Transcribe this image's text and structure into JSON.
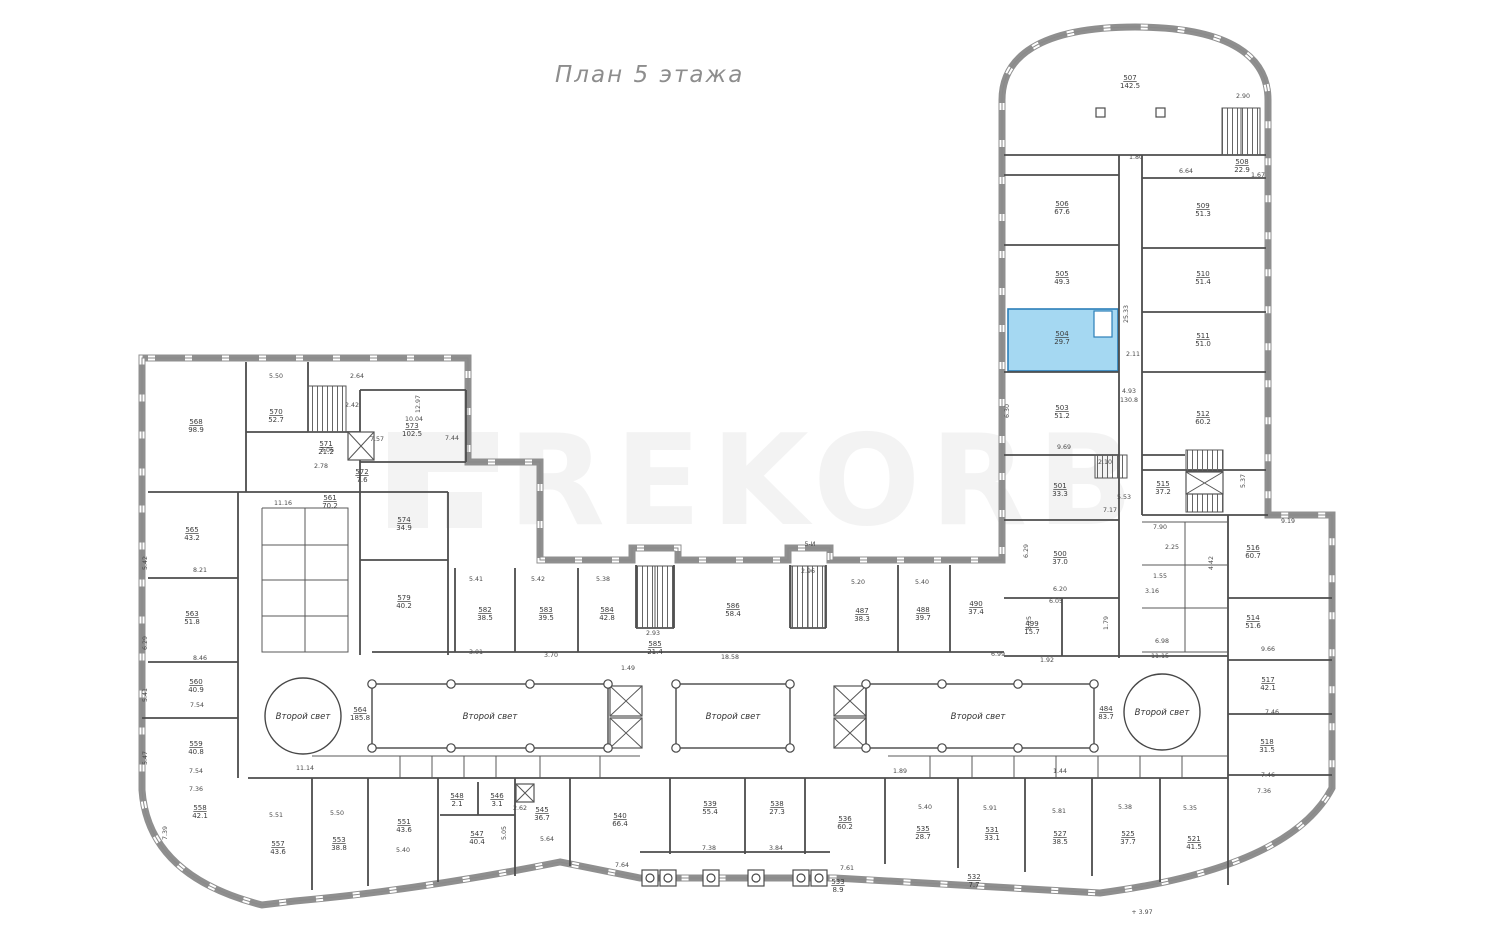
{
  "page": {
    "title": "План 5 этажа",
    "watermark": "REKORB",
    "elevation_note": "+ 3.97",
    "axis_note": "5-И"
  },
  "colors": {
    "highlight_fill": "#A5D8F2",
    "highlight_border": "#2B7FB8"
  },
  "atrium": {
    "label": "Второй свет"
  },
  "highlight": {
    "room": "504",
    "area": "29.7"
  },
  "rooms": {
    "r568": {
      "n": "568",
      "a": "98.9"
    },
    "r570": {
      "n": "570",
      "a": "52.7"
    },
    "r571": {
      "n": "571",
      "a": "21.2"
    },
    "r572": {
      "n": "572",
      "a": "7.6"
    },
    "r573": {
      "n": "573",
      "a": "102.5"
    },
    "r561": {
      "n": "561",
      "a": "70.2"
    },
    "r574": {
      "n": "574",
      "a": "34.9"
    },
    "r565": {
      "n": "565",
      "a": "43.2"
    },
    "r563": {
      "n": "563",
      "a": "51.8"
    },
    "r560": {
      "n": "560",
      "a": "40.9"
    },
    "r559": {
      "n": "559",
      "a": "40.8"
    },
    "r558": {
      "n": "558",
      "a": "42.1"
    },
    "r557": {
      "n": "557",
      "a": "43.6"
    },
    "r553": {
      "n": "553",
      "a": "38.8"
    },
    "r551": {
      "n": "551",
      "a": "43.6"
    },
    "r548": {
      "n": "548",
      "a": "2.1"
    },
    "r546": {
      "n": "546",
      "a": "3.1"
    },
    "r547": {
      "n": "547",
      "a": "40.4"
    },
    "r545": {
      "n": "545",
      "a": "36.7"
    },
    "r540": {
      "n": "540",
      "a": "66.4"
    },
    "r539": {
      "n": "539",
      "a": "55.4"
    },
    "r538": {
      "n": "538",
      "a": "27.3"
    },
    "r536": {
      "n": "536",
      "a": "60.2"
    },
    "r535": {
      "n": "535",
      "a": "28.7"
    },
    "r531": {
      "n": "531",
      "a": "33.1"
    },
    "r527": {
      "n": "527",
      "a": "38.5"
    },
    "r525": {
      "n": "525",
      "a": "37.7"
    },
    "r521": {
      "n": "521",
      "a": "41.5"
    },
    "r533": {
      "n": "533",
      "a": "8.9"
    },
    "r532": {
      "n": "532",
      "a": "7.7"
    },
    "r579": {
      "n": "579",
      "a": "40.2"
    },
    "r582": {
      "n": "582",
      "a": "38.5"
    },
    "r583": {
      "n": "583",
      "a": "39.5"
    },
    "r584": {
      "n": "584",
      "a": "42.8"
    },
    "r585": {
      "n": "585",
      "a": "21.4"
    },
    "r586": {
      "n": "586",
      "a": "58.4"
    },
    "r487": {
      "n": "487",
      "a": "38.3"
    },
    "r488": {
      "n": "488",
      "a": "39.7"
    },
    "r490": {
      "n": "490",
      "a": "37.4"
    },
    "r564": {
      "n": "564",
      "a": "185.8"
    },
    "r484": {
      "n": "484",
      "a": "83.7"
    },
    "r507": {
      "n": "507",
      "a": "142.5"
    },
    "r508": {
      "n": "508",
      "a": "22.9"
    },
    "r506": {
      "n": "506",
      "a": "67.6"
    },
    "r505": {
      "n": "505",
      "a": "49.3"
    },
    "r504": {
      "n": "504",
      "a": "29.7"
    },
    "r503": {
      "n": "503",
      "a": "51.2"
    },
    "r509": {
      "n": "509",
      "a": "51.3"
    },
    "r510": {
      "n": "510",
      "a": "51.4"
    },
    "r511": {
      "n": "511",
      "a": "51.0"
    },
    "r512": {
      "n": "512",
      "a": "60.2"
    },
    "r501": {
      "n": "501",
      "a": "33.3"
    },
    "r500": {
      "n": "500",
      "a": "37.0"
    },
    "r499": {
      "n": "499",
      "a": "15.7"
    },
    "r515": {
      "n": "515",
      "a": "37.2"
    },
    "r516": {
      "n": "516",
      "a": "60.7"
    },
    "r514": {
      "n": "514",
      "a": "51.6"
    },
    "r517": {
      "n": "517",
      "a": "42.1"
    },
    "r518": {
      "n": "518",
      "a": "31.5"
    }
  },
  "dims": [
    "5.50",
    "2.64",
    "12.97",
    "10.04",
    "2.42",
    "7.57",
    "7.44",
    "3.06",
    "2.78",
    "11.16",
    "5.42",
    "8.21",
    "6.29",
    "8.46",
    "5.41",
    "7.54",
    "5.47",
    "7.54",
    "7.36",
    "7.39",
    "11.14",
    "5.51",
    "5.50",
    "5.40",
    "2.62",
    "5.05",
    "5.64",
    "7.64",
    "1.49",
    "18.58",
    "5.38",
    "5.41",
    "5.42",
    "2.93",
    "3.01",
    "3.70",
    "2.96",
    "5.20",
    "5.40",
    "7.38",
    "3.84",
    "7.61",
    "1.80",
    "2.90",
    "6.64",
    "1.67",
    "25.33",
    "2.11",
    "4.93",
    "130.8",
    "6.30",
    "9.69",
    "2.10",
    "5.53",
    "7.17",
    "5.37",
    "9.19",
    "6.29",
    "6.20",
    "6.05",
    "5.25",
    "1.79",
    "7.90",
    "2.25",
    "4.42",
    "1.55",
    "3.16",
    "6.98",
    "11.15",
    "9.66",
    "7.46",
    "7.46",
    "7.36",
    "5.40",
    "5.91",
    "5.81",
    "5.38",
    "5.35",
    "1.89",
    "1.44",
    "1.92",
    "6.99"
  ]
}
